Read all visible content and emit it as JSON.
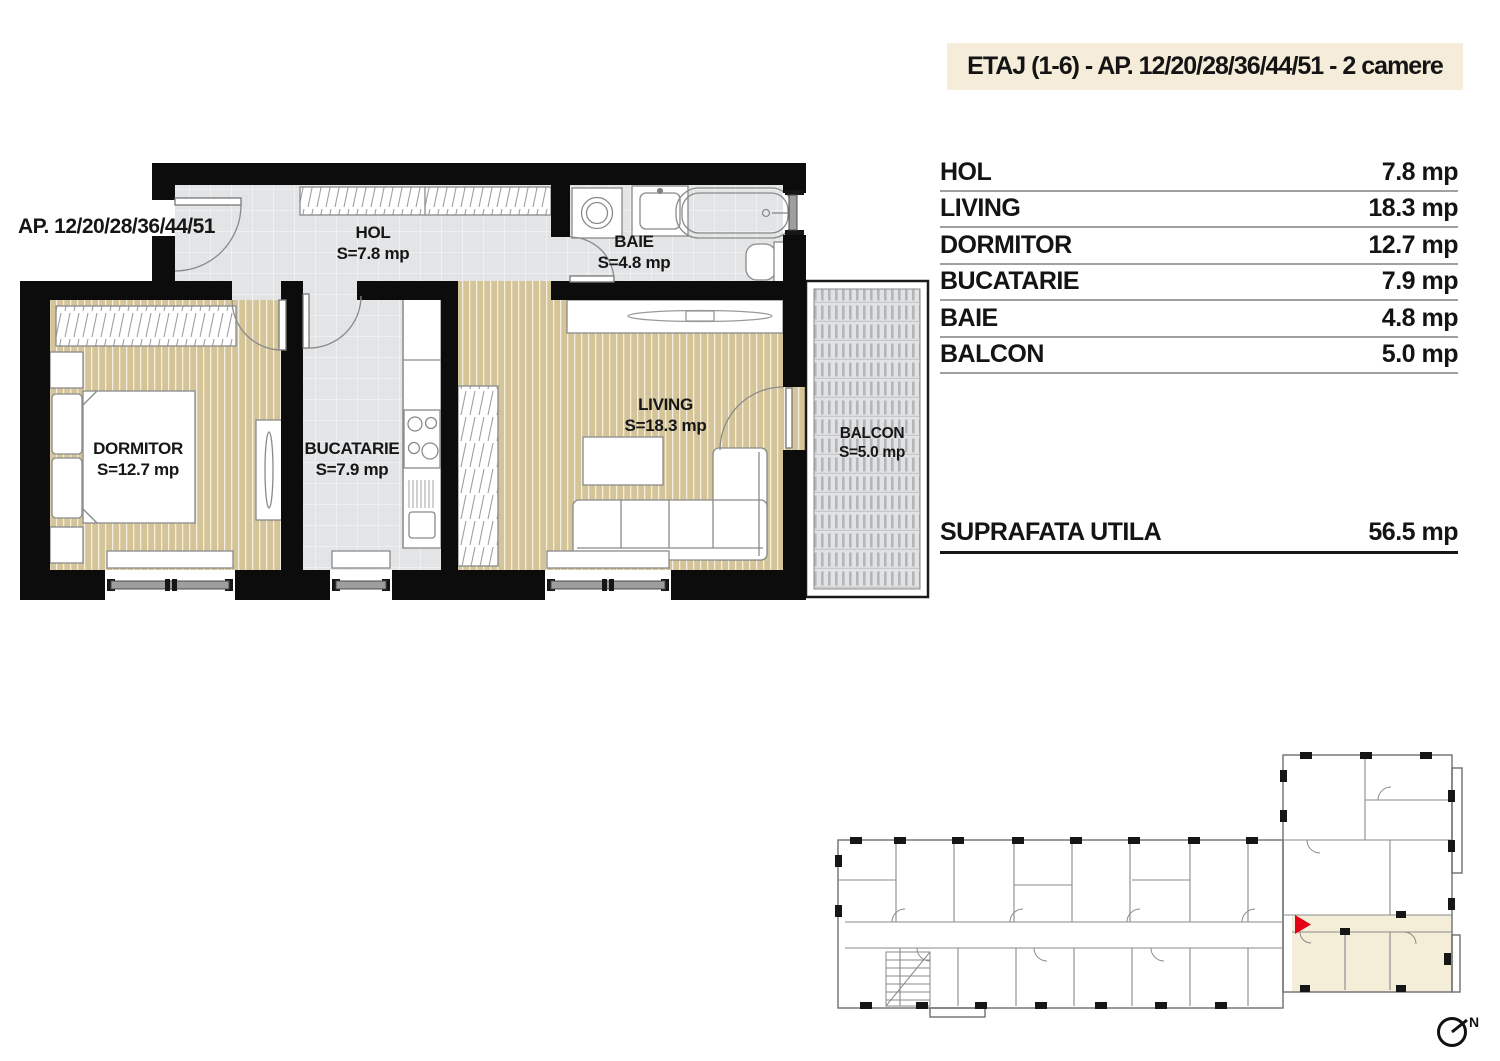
{
  "header": {
    "title": "ETAJ (1-6) - AP. 12/20/28/36/44/51 - 2 camere"
  },
  "plan": {
    "apartment_label": "AP. 12/20/28/36/44/51",
    "rooms": [
      {
        "name": "HOL",
        "area": "S=7.8 mp"
      },
      {
        "name": "BAIE",
        "area": "S=4.8 mp"
      },
      {
        "name": "DORMITOR",
        "area": "S=12.7 mp"
      },
      {
        "name": "BUCATARIE",
        "area": "S=7.9 mp"
      },
      {
        "name": "LIVING",
        "area": "S=18.3 mp"
      },
      {
        "name": "BALCON",
        "area": "S=5.0 mp"
      }
    ]
  },
  "table": {
    "rows": [
      {
        "label": "HOL",
        "value": "7.8 mp"
      },
      {
        "label": "LIVING",
        "value": "18.3 mp"
      },
      {
        "label": "DORMITOR",
        "value": "12.7 mp"
      },
      {
        "label": "BUCATARIE",
        "value": "7.9 mp"
      },
      {
        "label": "BAIE",
        "value": "4.8 mp"
      },
      {
        "label": "BALCON",
        "value": "5.0 mp"
      }
    ],
    "total": {
      "label": "SUPRAFATA UTILA",
      "value": "56.5 mp"
    }
  },
  "key_plan": {
    "north_label": "N"
  },
  "colors": {
    "highlight_cream": "#f5ecda",
    "wall_black": "#0c0c0c",
    "wood_floor": "#d4c498",
    "tile_floor": "#e2e4e6",
    "balcony_gray": "#e1e2e4",
    "entrance_arrow_red": "#e30016",
    "table_line_gray": "#a0a0a0"
  }
}
